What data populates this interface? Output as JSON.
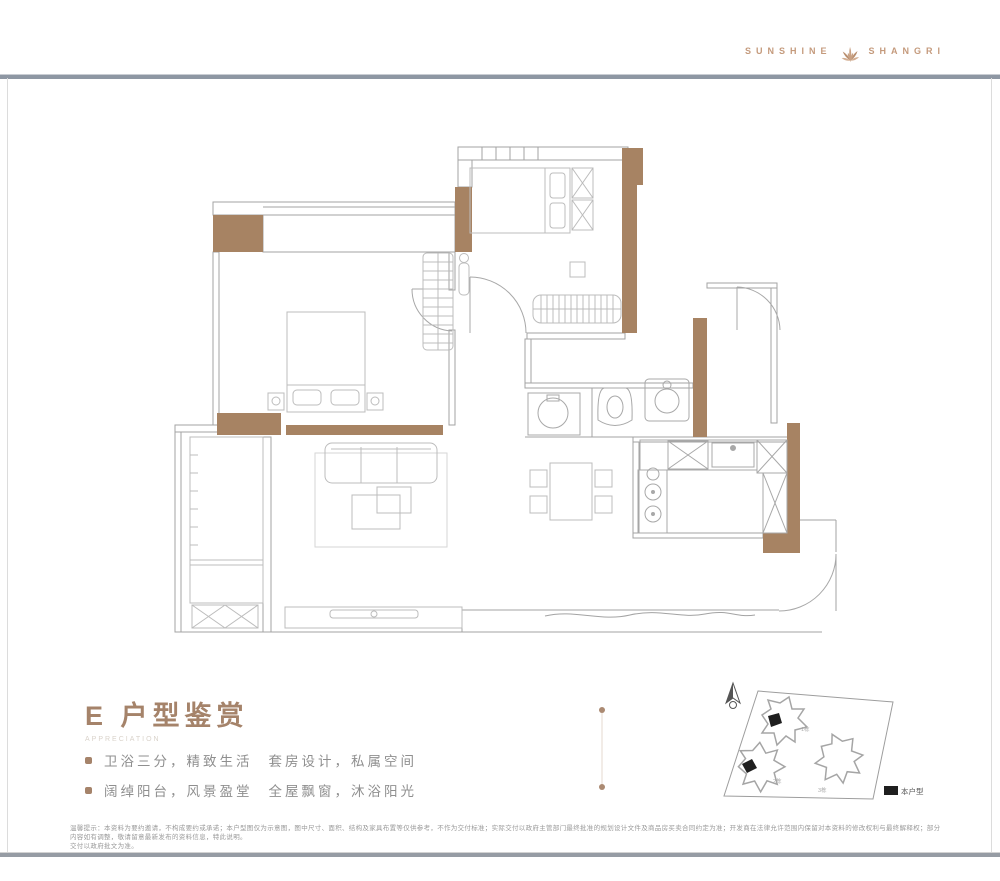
{
  "brand": {
    "name_left": "SUNSHINE",
    "name_right": "SHANGRI"
  },
  "title": {
    "text": "E 户型鉴赏",
    "subtitle": "APPRECIATION"
  },
  "features": [
    {
      "part1": "卫浴三分，精致生活",
      "part2": "套房设计，私属空间"
    },
    {
      "part1": "阔绰阳台，风景盈堂",
      "part2": "全屋飘窗，沐浴阳光"
    }
  ],
  "siteplan": {
    "legend": "本户型",
    "building_labels": [
      "1栋",
      "2栋",
      "3栋"
    ]
  },
  "disclaimer": {
    "line1": "温馨提示：本资料为要约邀请，不构成要约或承诺；本户型图仅为示意图，图中尺寸、面积、结构及家具布置等仅供参考，不作为交付标准；实际交付以政府主管部门最终批准的规划设计文件及商品房买卖合同约定为准；开发商在法律允许范围内保留对本资料的修改权利与最终解释权；部分内容如有调整，敬请留意最新发布的资料信息，特此说明。",
    "line2": "交付以政府批文为准。"
  },
  "colors": {
    "wall_brown": "#a78363",
    "accent": "#a5836a",
    "logo_tan": "#c49a7c",
    "line_gray": "#a3a3a3",
    "highlight_black": "#1f1f1f"
  }
}
